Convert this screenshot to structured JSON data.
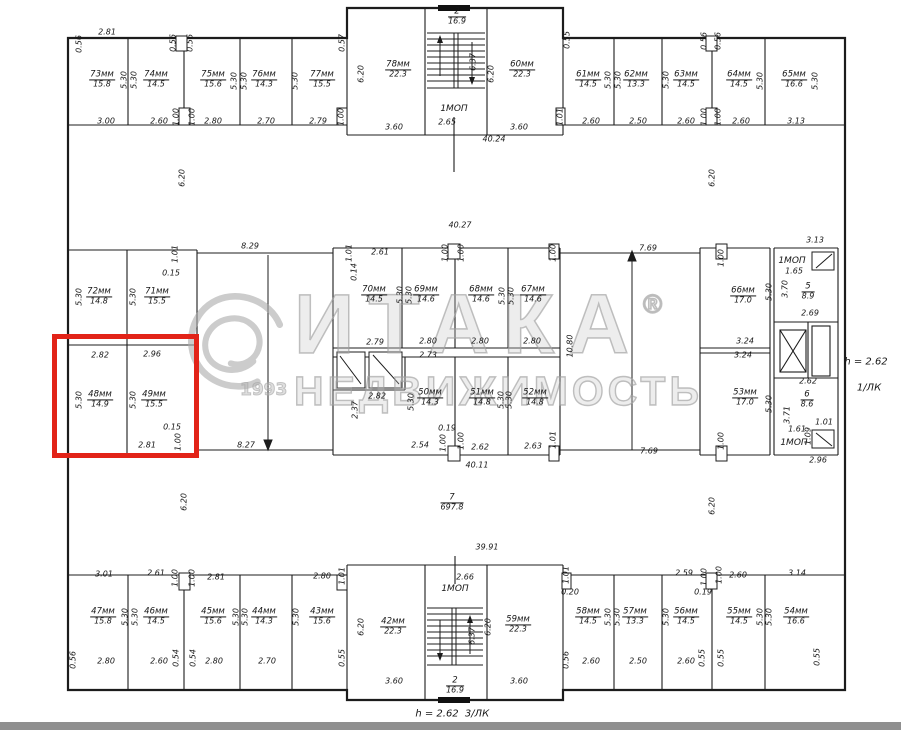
{
  "watermark": {
    "brand": "ИТАКА",
    "reg": "®",
    "year": "1993",
    "subtitle": "НЕДВИЖИМОСТЬ"
  },
  "side_note": {
    "height": "h = 2.62",
    "stair": "1/ЛК"
  },
  "footer_note": {
    "height": "h = 2.62",
    "stair": "3/ЛК"
  },
  "highlight": {
    "color": "#e22318",
    "units": [
      "48мм",
      "49мм"
    ]
  },
  "labels": [
    {
      "t": "0.56",
      "x": 80,
      "y": 44,
      "r": 1
    },
    {
      "t": "2.81",
      "x": 107,
      "y": 33
    },
    {
      "t": "0.56",
      "x": 174,
      "y": 43,
      "r": 1
    },
    {
      "t": "0.56",
      "x": 191,
      "y": 43,
      "r": 1
    },
    {
      "t": "0.57",
      "x": 343,
      "y": 43,
      "r": 1
    },
    {
      "t": "73мм",
      "a": "15.8",
      "x": 102,
      "y": 80,
      "k": "room"
    },
    {
      "t": "5.30",
      "x": 125,
      "y": 80,
      "r": 1
    },
    {
      "t": "5.30",
      "x": 135,
      "y": 80,
      "r": 1
    },
    {
      "t": "74мм",
      "a": "14.5",
      "x": 156,
      "y": 80,
      "k": "room"
    },
    {
      "t": "75мм",
      "a": "15.6",
      "x": 213,
      "y": 80,
      "k": "room"
    },
    {
      "t": "5.30",
      "x": 235,
      "y": 81,
      "r": 1
    },
    {
      "t": "5.30",
      "x": 245,
      "y": 81,
      "r": 1
    },
    {
      "t": "76мм",
      "a": "14.3",
      "x": 264,
      "y": 80,
      "k": "room"
    },
    {
      "t": "5.30",
      "x": 296,
      "y": 81,
      "r": 1
    },
    {
      "t": "77мм",
      "a": "15.5",
      "x": 322,
      "y": 80,
      "k": "room"
    },
    {
      "t": "3.00",
      "x": 106,
      "y": 122
    },
    {
      "t": "2.60",
      "x": 159,
      "y": 122
    },
    {
      "t": "1.00",
      "x": 177,
      "y": 117,
      "r": 1
    },
    {
      "t": "1.00",
      "x": 193,
      "y": 117,
      "r": 1
    },
    {
      "t": "2.80",
      "x": 213,
      "y": 122
    },
    {
      "t": "2.70",
      "x": 266,
      "y": 122
    },
    {
      "t": "2.79",
      "x": 318,
      "y": 122
    },
    {
      "t": "1.00",
      "x": 342,
      "y": 117,
      "r": 1
    },
    {
      "t": "6.20",
      "x": 362,
      "y": 74,
      "r": 1
    },
    {
      "t": "78мм",
      "a": "22.3",
      "x": 398,
      "y": 70,
      "k": "room"
    },
    {
      "t": "2",
      "a": "16.9",
      "x": 457,
      "y": 17,
      "k": "frac"
    },
    {
      "t": "6.37",
      "x": 474,
      "y": 62,
      "r": 1
    },
    {
      "t": "1МОП",
      "x": 454,
      "y": 110,
      "k": "mop"
    },
    {
      "t": "2.65",
      "x": 447,
      "y": 123
    },
    {
      "t": "3.60",
      "x": 394,
      "y": 128
    },
    {
      "t": "6.20",
      "x": 492,
      "y": 74,
      "r": 1
    },
    {
      "t": "60мм",
      "a": "22.3",
      "x": 522,
      "y": 70,
      "k": "room"
    },
    {
      "t": "3.60",
      "x": 519,
      "y": 128
    },
    {
      "t": "40.24",
      "x": 494,
      "y": 140
    },
    {
      "t": "0.55",
      "x": 568,
      "y": 40,
      "r": 1
    },
    {
      "t": "61мм",
      "a": "14.5",
      "x": 588,
      "y": 80,
      "k": "room"
    },
    {
      "t": "5.30",
      "x": 609,
      "y": 80,
      "r": 1
    },
    {
      "t": "5.30",
      "x": 619,
      "y": 80,
      "r": 1
    },
    {
      "t": "62мм",
      "a": "13.3",
      "x": 636,
      "y": 80,
      "k": "room"
    },
    {
      "t": "5.30",
      "x": 667,
      "y": 80,
      "r": 1
    },
    {
      "t": "63мм",
      "a": "14.5",
      "x": 686,
      "y": 80,
      "k": "room"
    },
    {
      "t": "0.56",
      "x": 705,
      "y": 41,
      "r": 1
    },
    {
      "t": "0.56",
      "x": 719,
      "y": 41,
      "r": 1
    },
    {
      "t": "64мм",
      "a": "14.5",
      "x": 739,
      "y": 80,
      "k": "room"
    },
    {
      "t": "5.30",
      "x": 761,
      "y": 81,
      "r": 1
    },
    {
      "t": "65мм",
      "a": "16.6",
      "x": 794,
      "y": 80,
      "k": "room"
    },
    {
      "t": "5.30",
      "x": 816,
      "y": 81,
      "r": 1
    },
    {
      "t": "1.01",
      "x": 561,
      "y": 117,
      "r": 1
    },
    {
      "t": "2.60",
      "x": 591,
      "y": 122
    },
    {
      "t": "2.50",
      "x": 638,
      "y": 122
    },
    {
      "t": "2.60",
      "x": 686,
      "y": 122
    },
    {
      "t": "1.00",
      "x": 705,
      "y": 117,
      "r": 1
    },
    {
      "t": "1.00",
      "x": 719,
      "y": 117,
      "r": 1
    },
    {
      "t": "2.60",
      "x": 741,
      "y": 122
    },
    {
      "t": "3.13",
      "x": 796,
      "y": 122
    },
    {
      "t": "6.20",
      "x": 183,
      "y": 178,
      "r": 1
    },
    {
      "t": "40.27",
      "x": 460,
      "y": 226
    },
    {
      "t": "6.20",
      "x": 713,
      "y": 178,
      "r": 1
    },
    {
      "t": "1.01",
      "x": 176,
      "y": 254,
      "r": 1
    },
    {
      "t": "0.15",
      "x": 171,
      "y": 274
    },
    {
      "t": "5.30",
      "x": 80,
      "y": 297,
      "r": 1
    },
    {
      "t": "72мм",
      "a": "14.8",
      "x": 99,
      "y": 297,
      "k": "room"
    },
    {
      "t": "5.30",
      "x": 134,
      "y": 297,
      "r": 1
    },
    {
      "t": "71мм",
      "a": "15.5",
      "x": 157,
      "y": 297,
      "k": "room"
    },
    {
      "t": "2.82",
      "x": 100,
      "y": 356
    },
    {
      "t": "2.96",
      "x": 152,
      "y": 355
    },
    {
      "t": "5.30",
      "x": 80,
      "y": 400,
      "r": 1
    },
    {
      "t": "48мм",
      "a": "14.9",
      "x": 100,
      "y": 400,
      "k": "room"
    },
    {
      "t": "5.30",
      "x": 134,
      "y": 400,
      "r": 1
    },
    {
      "t": "49мм",
      "a": "15.5",
      "x": 154,
      "y": 400,
      "k": "room"
    },
    {
      "t": "0.15",
      "x": 172,
      "y": 428
    },
    {
      "t": "1.00",
      "x": 179,
      "y": 442,
      "r": 1
    },
    {
      "t": "2.81",
      "x": 147,
      "y": 446
    },
    {
      "t": "8.29",
      "x": 250,
      "y": 247
    },
    {
      "t": "8.27",
      "x": 246,
      "y": 446
    },
    {
      "t": "1.01",
      "x": 350,
      "y": 253,
      "r": 1
    },
    {
      "t": "2.61",
      "x": 380,
      "y": 253
    },
    {
      "t": "0.14",
      "x": 355,
      "y": 272,
      "r": 1
    },
    {
      "t": "70мм",
      "a": "14.5",
      "x": 374,
      "y": 295,
      "k": "room"
    },
    {
      "t": "5.30",
      "x": 401,
      "y": 295,
      "r": 1
    },
    {
      "t": "5.30",
      "x": 410,
      "y": 295,
      "r": 1
    },
    {
      "t": "1.00",
      "x": 446,
      "y": 253,
      "r": 1
    },
    {
      "t": "1.00",
      "x": 462,
      "y": 253,
      "r": 1
    },
    {
      "t": "69мм",
      "a": "14.6",
      "x": 426,
      "y": 295,
      "k": "room"
    },
    {
      "t": "5.30",
      "x": 503,
      "y": 296,
      "r": 1
    },
    {
      "t": "5.30",
      "x": 512,
      "y": 296,
      "r": 1
    },
    {
      "t": "68мм",
      "a": "14.6",
      "x": 481,
      "y": 295,
      "k": "room"
    },
    {
      "t": "1.00",
      "x": 554,
      "y": 253,
      "r": 1
    },
    {
      "t": "67мм",
      "a": "14.6",
      "x": 533,
      "y": 295,
      "k": "room"
    },
    {
      "t": "2.79",
      "x": 375,
      "y": 343
    },
    {
      "t": "2.80",
      "x": 428,
      "y": 342
    },
    {
      "t": "2.80",
      "x": 480,
      "y": 342
    },
    {
      "t": "2.80",
      "x": 532,
      "y": 342
    },
    {
      "t": "10.80",
      "x": 571,
      "y": 346,
      "r": 1
    },
    {
      "t": "2.73",
      "x": 428,
      "y": 356
    },
    {
      "t": "2.82",
      "x": 377,
      "y": 397
    },
    {
      "t": "2.37",
      "x": 356,
      "y": 410,
      "r": 1
    },
    {
      "t": "5.30",
      "x": 412,
      "y": 402,
      "r": 1
    },
    {
      "t": "50мм",
      "a": "14.3",
      "x": 430,
      "y": 398,
      "k": "room"
    },
    {
      "t": "5.30",
      "x": 502,
      "y": 400,
      "r": 1
    },
    {
      "t": "5.30",
      "x": 510,
      "y": 400,
      "r": 1
    },
    {
      "t": "51мм",
      "a": "14.8",
      "x": 482,
      "y": 398,
      "k": "room"
    },
    {
      "t": "52мм",
      "a": "14.8",
      "x": 535,
      "y": 398,
      "k": "room"
    },
    {
      "t": "0.19",
      "x": 447,
      "y": 429
    },
    {
      "t": "1.00",
      "x": 444,
      "y": 443,
      "r": 1
    },
    {
      "t": "1.00",
      "x": 462,
      "y": 441,
      "r": 1
    },
    {
      "t": "2.54",
      "x": 420,
      "y": 446
    },
    {
      "t": "2.62",
      "x": 480,
      "y": 448
    },
    {
      "t": "2.63",
      "x": 533,
      "y": 447
    },
    {
      "t": "1.01",
      "x": 554,
      "y": 440,
      "r": 1
    },
    {
      "t": "40.11",
      "x": 477,
      "y": 466
    },
    {
      "t": "7.69",
      "x": 648,
      "y": 249
    },
    {
      "t": "7.69",
      "x": 649,
      "y": 452
    },
    {
      "t": "1.00",
      "x": 722,
      "y": 258,
      "r": 1
    },
    {
      "t": "66мм",
      "a": "17.0",
      "x": 743,
      "y": 296,
      "k": "room"
    },
    {
      "t": "5.30",
      "x": 770,
      "y": 292,
      "r": 1
    },
    {
      "t": "3.24",
      "x": 745,
      "y": 342
    },
    {
      "t": "3.24",
      "x": 743,
      "y": 356
    },
    {
      "t": "53мм",
      "a": "17.0",
      "x": 745,
      "y": 398,
      "k": "room"
    },
    {
      "t": "5.30",
      "x": 770,
      "y": 404,
      "r": 1
    },
    {
      "t": "1.00",
      "x": 722,
      "y": 441,
      "r": 1
    },
    {
      "t": "3.13",
      "x": 815,
      "y": 241
    },
    {
      "t": "1МОП",
      "x": 792,
      "y": 262,
      "k": "mop"
    },
    {
      "t": "1.65",
      "x": 794,
      "y": 272
    },
    {
      "t": "3.70",
      "x": 786,
      "y": 289,
      "r": 1
    },
    {
      "t": "5",
      "a": "8.9",
      "x": 808,
      "y": 292,
      "k": "frac"
    },
    {
      "t": "2.69",
      "x": 810,
      "y": 314
    },
    {
      "t": "2.62",
      "x": 808,
      "y": 382
    },
    {
      "t": "6",
      "a": "8.6",
      "x": 807,
      "y": 400,
      "k": "frac"
    },
    {
      "t": "3.71",
      "x": 788,
      "y": 415,
      "r": 1
    },
    {
      "t": "1.61",
      "x": 797,
      "y": 430
    },
    {
      "t": "1.09",
      "x": 809,
      "y": 436,
      "r": 1
    },
    {
      "t": "1.01",
      "x": 824,
      "y": 423
    },
    {
      "t": "1МОП",
      "x": 794,
      "y": 444,
      "k": "mop"
    },
    {
      "t": "2.96",
      "x": 818,
      "y": 461
    },
    {
      "t": "6.20",
      "x": 185,
      "y": 502,
      "r": 1
    },
    {
      "t": "7",
      "a": "697.8",
      "x": 452,
      "y": 503,
      "k": "frac"
    },
    {
      "t": "6.20",
      "x": 713,
      "y": 506,
      "r": 1
    },
    {
      "t": "39.91",
      "x": 487,
      "y": 548
    },
    {
      "t": "3.01",
      "x": 104,
      "y": 575
    },
    {
      "t": "2.61",
      "x": 156,
      "y": 574
    },
    {
      "t": "1.00",
      "x": 176,
      "y": 578,
      "r": 1
    },
    {
      "t": "1.00",
      "x": 193,
      "y": 578,
      "r": 1
    },
    {
      "t": "2.81",
      "x": 216,
      "y": 578
    },
    {
      "t": "2.80",
      "x": 322,
      "y": 577
    },
    {
      "t": "1.01",
      "x": 343,
      "y": 576,
      "r": 1
    },
    {
      "t": "47мм",
      "a": "15.8",
      "x": 103,
      "y": 617,
      "k": "room"
    },
    {
      "t": "5.30",
      "x": 126,
      "y": 617,
      "r": 1
    },
    {
      "t": "5.30",
      "x": 136,
      "y": 617,
      "r": 1
    },
    {
      "t": "46мм",
      "a": "14.5",
      "x": 156,
      "y": 617,
      "k": "room"
    },
    {
      "t": "45мм",
      "a": "15.6",
      "x": 213,
      "y": 617,
      "k": "room"
    },
    {
      "t": "5.30",
      "x": 237,
      "y": 617,
      "r": 1
    },
    {
      "t": "5.30",
      "x": 246,
      "y": 617,
      "r": 1
    },
    {
      "t": "44мм",
      "a": "14.3",
      "x": 264,
      "y": 617,
      "k": "room"
    },
    {
      "t": "5.30",
      "x": 297,
      "y": 617,
      "r": 1
    },
    {
      "t": "43мм",
      "a": "15.6",
      "x": 322,
      "y": 617,
      "k": "room"
    },
    {
      "t": "0.56",
      "x": 74,
      "y": 660,
      "r": 1
    },
    {
      "t": "2.80",
      "x": 106,
      "y": 662
    },
    {
      "t": "2.60",
      "x": 159,
      "y": 662
    },
    {
      "t": "0.54",
      "x": 177,
      "y": 658,
      "r": 1
    },
    {
      "t": "0.54",
      "x": 194,
      "y": 658,
      "r": 1
    },
    {
      "t": "2.80",
      "x": 214,
      "y": 662
    },
    {
      "t": "2.70",
      "x": 267,
      "y": 662
    },
    {
      "t": "0.55",
      "x": 343,
      "y": 658,
      "r": 1
    },
    {
      "t": "6.20",
      "x": 362,
      "y": 627,
      "r": 1
    },
    {
      "t": "42мм",
      "a": "22.3",
      "x": 393,
      "y": 627,
      "k": "room"
    },
    {
      "t": "2.66",
      "x": 465,
      "y": 578
    },
    {
      "t": "1МОП",
      "x": 455,
      "y": 590,
      "k": "mop"
    },
    {
      "t": "6.37",
      "x": 473,
      "y": 636,
      "r": 1
    },
    {
      "t": "2",
      "a": "16.9",
      "x": 455,
      "y": 686,
      "k": "frac"
    },
    {
      "t": "3.60",
      "x": 394,
      "y": 682
    },
    {
      "t": "6.20",
      "x": 489,
      "y": 627,
      "r": 1
    },
    {
      "t": "59мм",
      "a": "22.3",
      "x": 518,
      "y": 625,
      "k": "room"
    },
    {
      "t": "3.60",
      "x": 519,
      "y": 682
    },
    {
      "t": "1.01",
      "x": 567,
      "y": 575,
      "r": 1
    },
    {
      "t": "0.20",
      "x": 570,
      "y": 593
    },
    {
      "t": "58мм",
      "a": "14.5",
      "x": 588,
      "y": 617,
      "k": "room"
    },
    {
      "t": "5.30",
      "x": 609,
      "y": 617,
      "r": 1
    },
    {
      "t": "5.30",
      "x": 618,
      "y": 617,
      "r": 1
    },
    {
      "t": "57мм",
      "a": "13.3",
      "x": 635,
      "y": 617,
      "k": "room"
    },
    {
      "t": "5.30",
      "x": 667,
      "y": 617,
      "r": 1
    },
    {
      "t": "56мм",
      "a": "14.5",
      "x": 686,
      "y": 617,
      "k": "room"
    },
    {
      "t": "2.59",
      "x": 684,
      "y": 574
    },
    {
      "t": "1.00",
      "x": 705,
      "y": 577,
      "r": 1
    },
    {
      "t": "0.19",
      "x": 703,
      "y": 593
    },
    {
      "t": "1.00",
      "x": 720,
      "y": 575,
      "r": 1
    },
    {
      "t": "2.60",
      "x": 738,
      "y": 576
    },
    {
      "t": "55мм",
      "a": "14.5",
      "x": 739,
      "y": 617,
      "k": "room"
    },
    {
      "t": "5.30",
      "x": 761,
      "y": 617,
      "r": 1
    },
    {
      "t": "5.30",
      "x": 770,
      "y": 617,
      "r": 1
    },
    {
      "t": "3.14",
      "x": 797,
      "y": 574
    },
    {
      "t": "54мм",
      "a": "16.6",
      "x": 796,
      "y": 617,
      "k": "room"
    },
    {
      "t": "0.56",
      "x": 567,
      "y": 660,
      "r": 1
    },
    {
      "t": "2.60",
      "x": 591,
      "y": 662
    },
    {
      "t": "2.50",
      "x": 638,
      "y": 662
    },
    {
      "t": "2.60",
      "x": 686,
      "y": 662
    },
    {
      "t": "0.55",
      "x": 703,
      "y": 658,
      "r": 1
    },
    {
      "t": "0.55",
      "x": 722,
      "y": 658,
      "r": 1
    },
    {
      "t": "0.55",
      "x": 818,
      "y": 657,
      "r": 1
    }
  ]
}
